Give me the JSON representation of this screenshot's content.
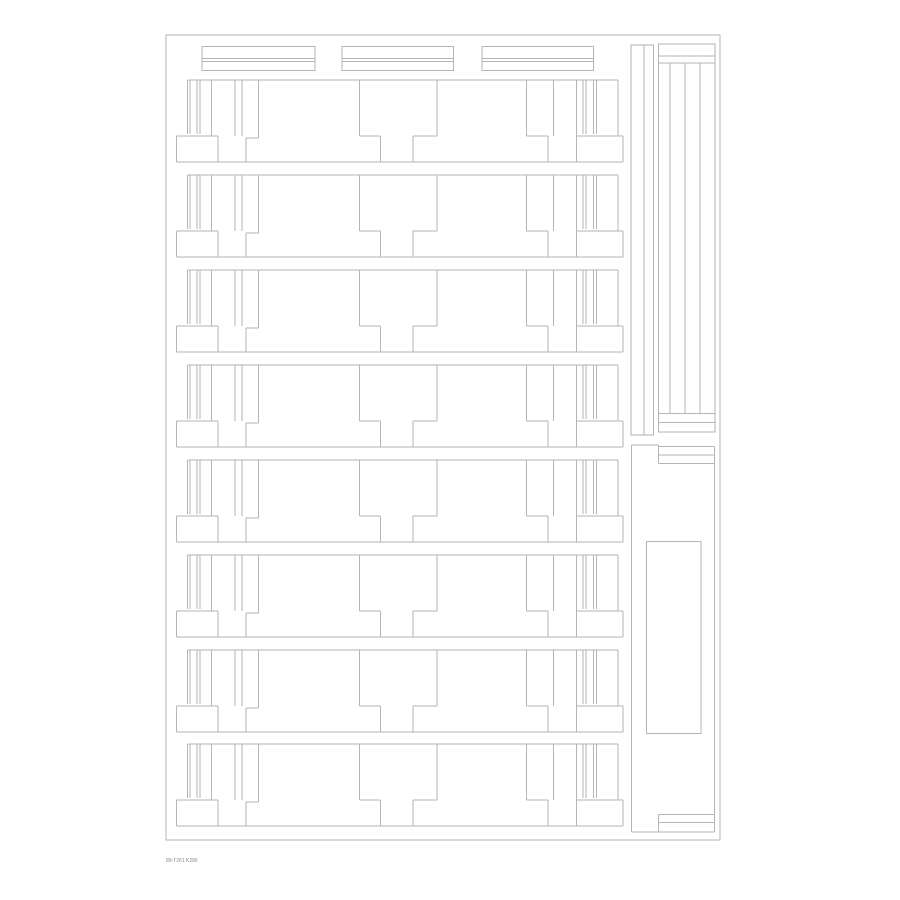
{
  "title": "cut-template-sheet",
  "footer": {
    "text": "89-T261 K286"
  },
  "colors": {
    "background": "#ffffff",
    "line": "#b2b6b6"
  },
  "drawing": {
    "sheet_border": [
      166,
      35,
      554,
      805
    ],
    "top_strips": {
      "rects": [
        [
          202,
          46.5,
          113,
          24
        ],
        [
          342,
          46.5,
          111.5,
          24
        ],
        [
          482,
          46.5,
          111.5,
          24
        ]
      ],
      "inner_line_ys": [
        58.3,
        61.5
      ]
    },
    "rows": {
      "origin_x": 176.5,
      "tops": [
        80,
        175,
        270,
        365,
        460,
        555,
        650,
        744
      ],
      "segments": [
        [
          11,
          0,
          441.5,
          0
        ],
        [
          11,
          0,
          11,
          54
        ],
        [
          13.5,
          0,
          13.5,
          54
        ],
        [
          20.5,
          0,
          20.5,
          54
        ],
        [
          23.5,
          0,
          23.5,
          54
        ],
        [
          406.5,
          0,
          406.5,
          54
        ],
        [
          409.5,
          0,
          409.5,
          54
        ],
        [
          417,
          0,
          417,
          54
        ],
        [
          420,
          0,
          420,
          54
        ],
        [
          35,
          0,
          35,
          56
        ],
        [
          58.5,
          0,
          58.5,
          56
        ],
        [
          65.5,
          0,
          65.5,
          56
        ],
        [
          82,
          0,
          82,
          58
        ],
        [
          183,
          0,
          183,
          56
        ],
        [
          260.5,
          0,
          260.5,
          56
        ],
        [
          350,
          0,
          350,
          56
        ],
        [
          377,
          0,
          377,
          56
        ],
        [
          400,
          0,
          400,
          56
        ],
        [
          441.5,
          0,
          441.5,
          56
        ],
        [
          0,
          56,
          41.5,
          56
        ],
        [
          183,
          56,
          204,
          56
        ],
        [
          236.5,
          56,
          260.5,
          56
        ],
        [
          350,
          56,
          371.5,
          56
        ],
        [
          400,
          56,
          446.5,
          56
        ],
        [
          69.5,
          58,
          82,
          58
        ],
        [
          0,
          56,
          0,
          82
        ],
        [
          41.5,
          56,
          41.5,
          82
        ],
        [
          69.5,
          58,
          69.5,
          82
        ],
        [
          204,
          56,
          204,
          82
        ],
        [
          236.5,
          56,
          236.5,
          82
        ],
        [
          371.5,
          56,
          371.5,
          82
        ],
        [
          400,
          56,
          400,
          82
        ],
        [
          446.5,
          56,
          446.5,
          82
        ],
        [
          0,
          82,
          446.5,
          82
        ]
      ]
    },
    "side_strip_pair": {
      "rect": [
        631,
        45,
        22.5,
        390
      ],
      "divider": [
        644,
        45,
        644,
        435
      ]
    },
    "ladder": {
      "rect": [
        658.3,
        44,
        56.7,
        388
      ],
      "h_line_ys": [
        56,
        63,
        413.5,
        422.5
      ],
      "v_line_xs": [
        670,
        685,
        700
      ],
      "v_span": [
        63,
        413.5
      ]
    },
    "bottom_shape": {
      "segments": [
        [
          631.7,
          445,
          658.3,
          445
        ],
        [
          658.3,
          446.7,
          714.5,
          446.7
        ],
        [
          658.3,
          455,
          714.5,
          455
        ],
        [
          658.3,
          463.3,
          714.5,
          463.3
        ],
        [
          658.3,
          445,
          658.3,
          463.3
        ],
        [
          631.7,
          445,
          631.7,
          832
        ],
        [
          714.5,
          446.7,
          714.5,
          832
        ],
        [
          658.3,
          814.3,
          714.5,
          814.3
        ],
        [
          658.3,
          822.7,
          714.5,
          822.7
        ],
        [
          658.3,
          814.3,
          658.3,
          832
        ],
        [
          631.7,
          832,
          714.5,
          832
        ]
      ],
      "inner_rect": [
        646.7,
        541.7,
        54.3,
        191.6
      ]
    }
  }
}
